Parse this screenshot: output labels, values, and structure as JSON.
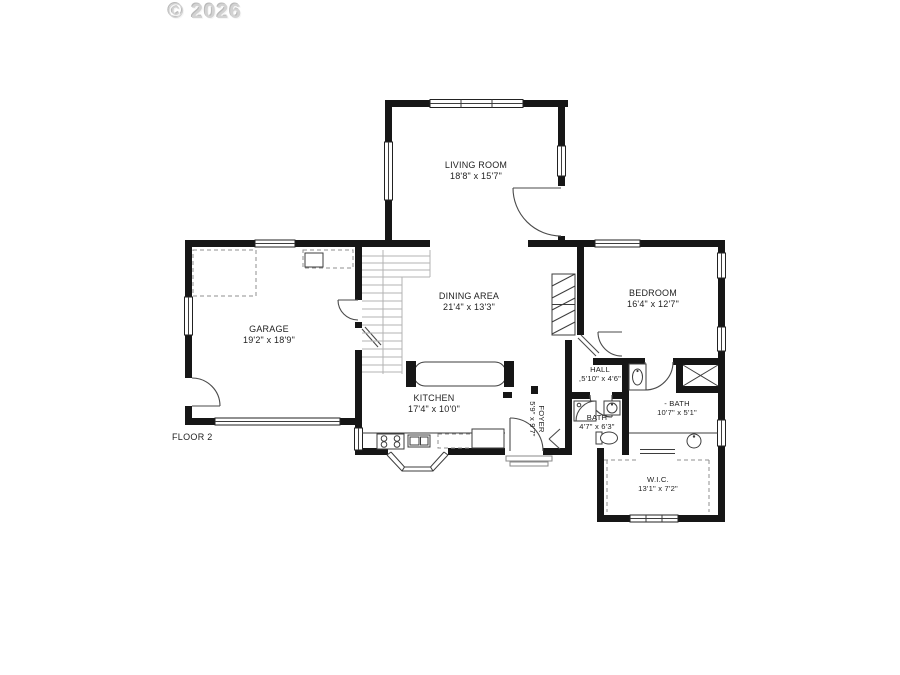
{
  "watermark": "© 2026",
  "floor_label": "FLOOR 2",
  "rooms": {
    "living_room": {
      "name": "LIVING ROOM",
      "dims": "18'8\" x 15'7\""
    },
    "garage": {
      "name": "GARAGE",
      "dims": "19'2\" x 18'9\""
    },
    "dining": {
      "name": "DINING AREA",
      "dims": "21'4\" x 13'3\""
    },
    "kitchen": {
      "name": "KITCHEN",
      "dims": "17'4\" x 10'0\""
    },
    "bedroom": {
      "name": "BEDROOM",
      "dims": "16'4\" x 12'7\""
    },
    "hall": {
      "name": "HALL",
      "dims": ",5'10\" x 4'6\""
    },
    "bath_small": {
      "name": "BATH",
      "dims": "4'7\" x 6'3\""
    },
    "bath_large": {
      "name": "- BATH",
      "dims": "10'7\" x 5'1\""
    },
    "wic": {
      "name": "W.I.C.",
      "dims": "13'1\" x 7'2\""
    },
    "foyer": {
      "name": "FOYER",
      "dims": "5'9\" x 9'7\""
    }
  },
  "colors": {
    "wall": "#161616",
    "background": "#ffffff",
    "stairs": "#b3b3b3",
    "watermark": "#d2d2d2"
  }
}
